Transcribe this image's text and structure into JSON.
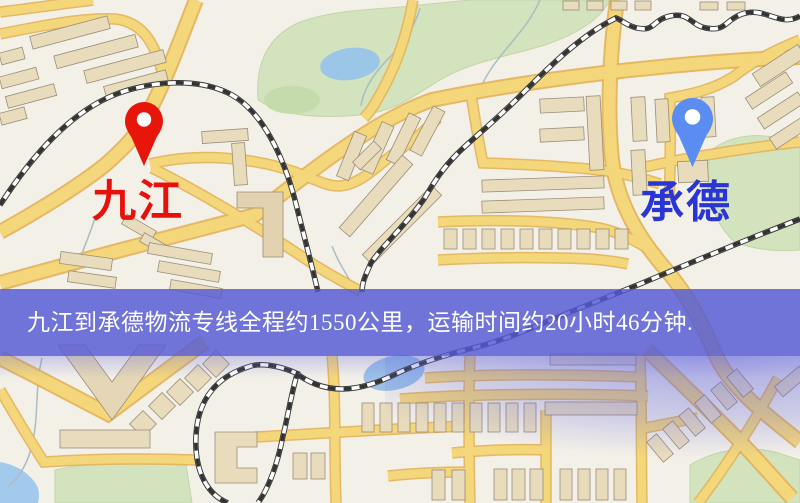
{
  "banner": {
    "text": "九江到承德物流专线全程约1550公里，运输时间约20小时46分钟.",
    "background": "#585cd5",
    "text_color": "#ffffff"
  },
  "route": {
    "origin": "九江",
    "destination": "承德",
    "distance": "约1550公里",
    "duration": "约20小时46分钟"
  },
  "markers": {
    "origin": {
      "label": "九江",
      "pin_color": "#e8150b",
      "label_color": "#e8100a",
      "icon": "map-pin"
    },
    "destination": {
      "label": "承德",
      "pin_color": "#5b8cf2",
      "label_color": "#2a35d5",
      "icon": "map-pin"
    }
  },
  "map": {
    "palette": {
      "background": "#f3f0e8",
      "road_fill": "#f4d67b",
      "road_casing": "#e3b158",
      "building": "#e9dcbd",
      "building_outline": "#9a8d78",
      "park": "#d3e3bd",
      "water": "#9cc6e8",
      "railway_dark": "#3a3a3a",
      "railway_light": "#ffffff",
      "haze": "#6165e1"
    }
  }
}
